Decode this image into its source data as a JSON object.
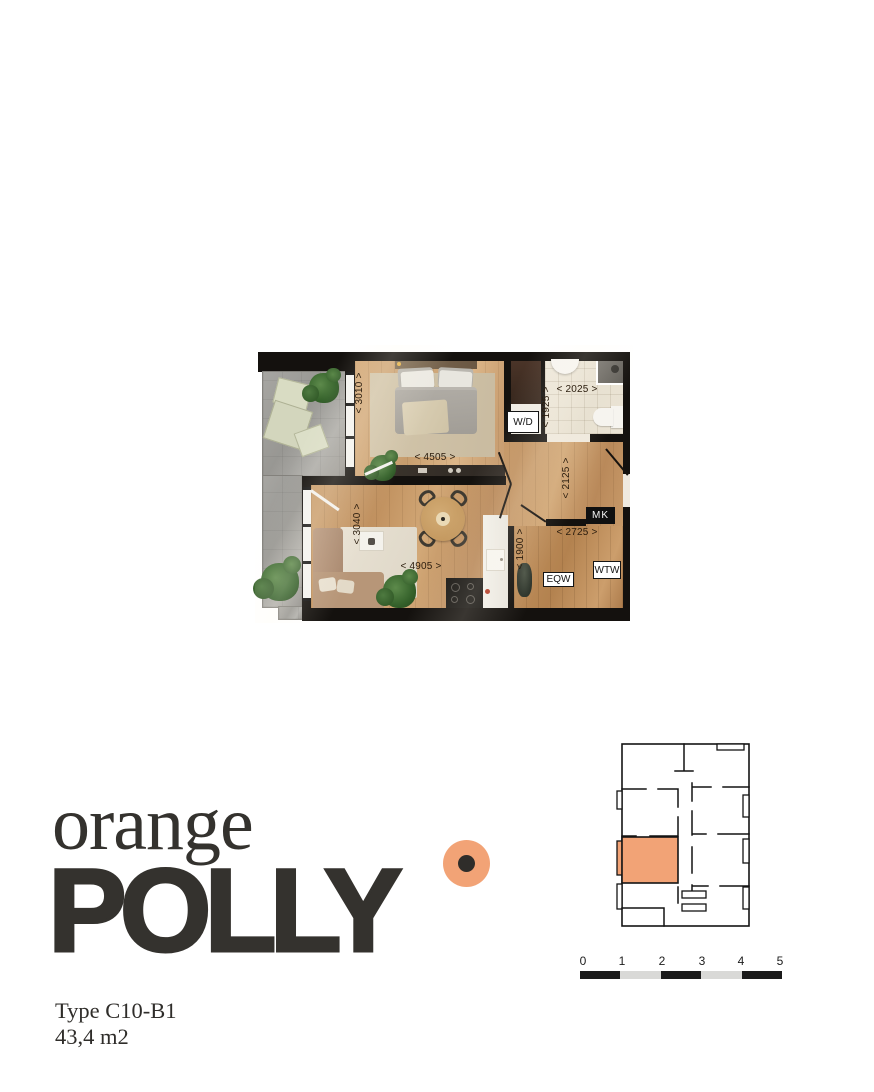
{
  "branding": {
    "word_serif": "orange",
    "word_bold": "POLLY",
    "type_label": "Type C10-B1",
    "area_label": "43,4 m2",
    "ink_color": "#34322E",
    "accent_color": "#F2A376"
  },
  "floorplan": {
    "dims": {
      "d3010": "< 3010 >",
      "d4505": "< 4505 >",
      "d2025": "< 2025 >",
      "d1925": "< 1925 >",
      "d2125": "< 2125 >",
      "d2725": "< 2725 >",
      "d1900": "< 1900 >",
      "d3040": "< 3040 >",
      "d4905": "< 4905 >"
    },
    "boxes": {
      "wd": "W/D",
      "mk": "MK",
      "eqw": "EQW",
      "wtw": "WTW"
    },
    "wall_color": "#14110E"
  },
  "minimap": {
    "highlight_color": "#F2A376",
    "outline_color": "#141414"
  },
  "scalebar": {
    "ticks": [
      "0",
      "1",
      "2",
      "3",
      "4",
      "5"
    ],
    "segment_colors": [
      "#1B1B1B",
      "#D9D9D7",
      "#1B1B1B",
      "#D9D9D7",
      "#1B1B1B"
    ]
  }
}
